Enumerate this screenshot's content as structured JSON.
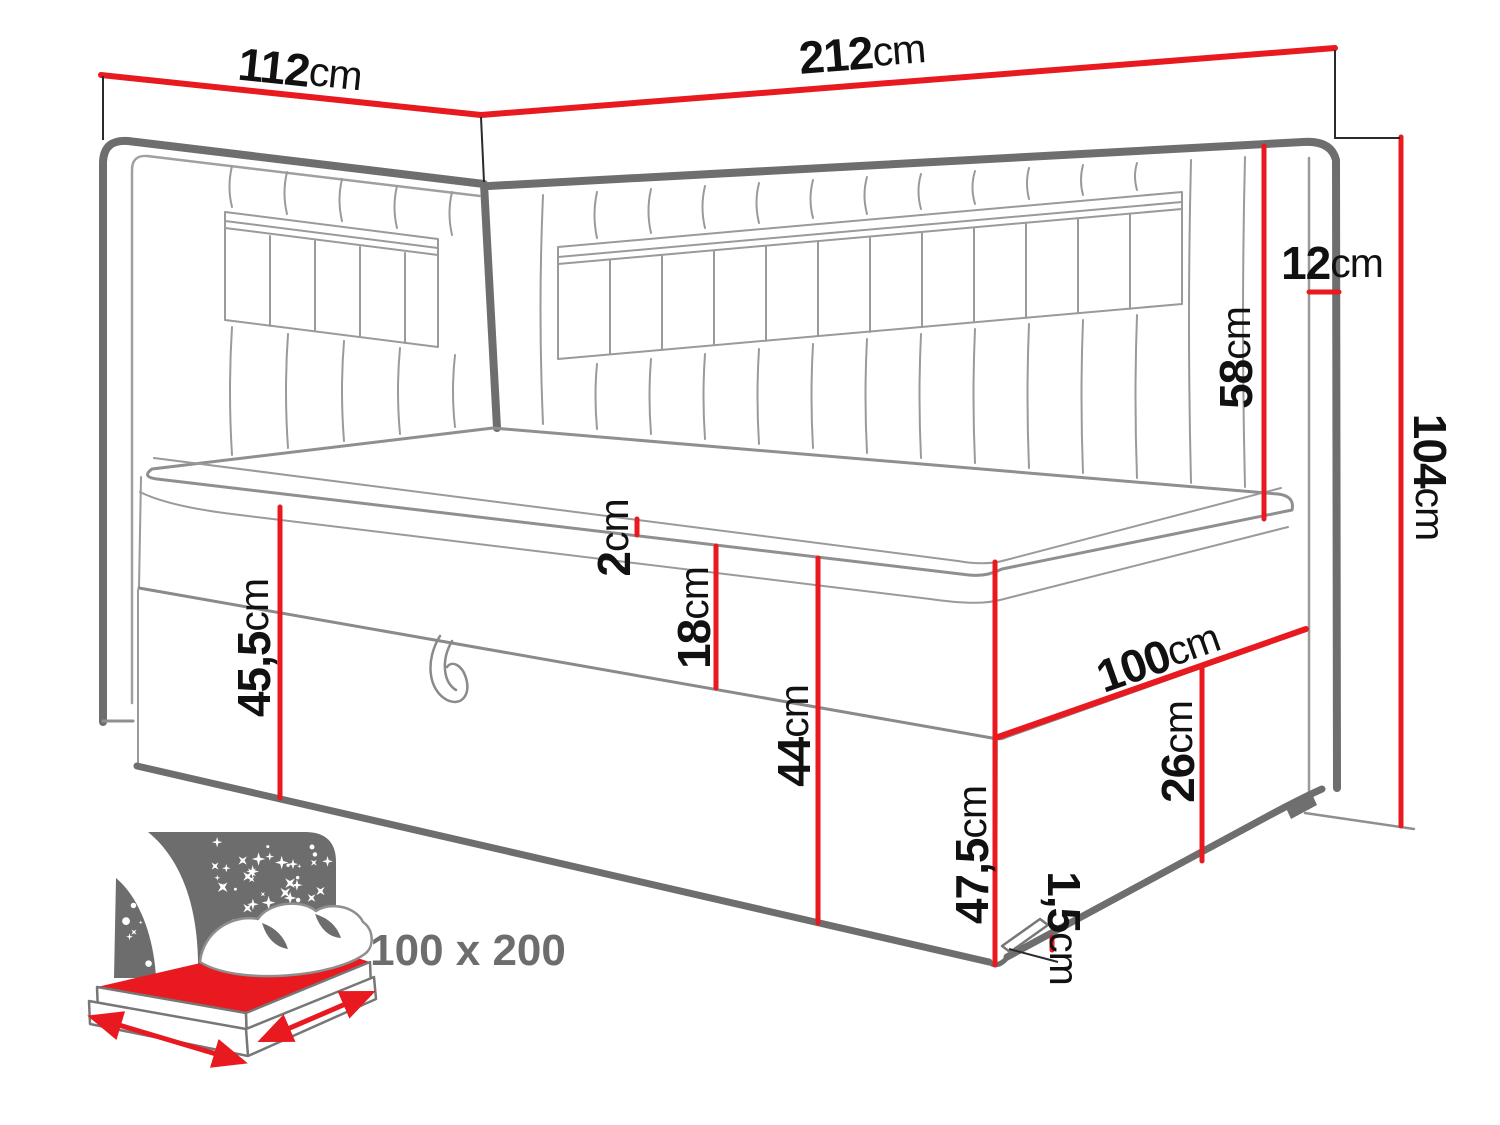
{
  "diagram": {
    "dims": {
      "left_width": {
        "value": "112",
        "unit": "cm"
      },
      "back_width": {
        "value": "212",
        "unit": "cm"
      },
      "headboard_thickness": {
        "value": "12",
        "unit": "cm"
      },
      "headboard_above_bed": {
        "value": "58",
        "unit": "cm"
      },
      "total_height": {
        "value": "104",
        "unit": "cm"
      },
      "topper_height": {
        "value": "2",
        "unit": "cm"
      },
      "mattress_height": {
        "value": "18",
        "unit": "cm"
      },
      "left_base_height": {
        "value": "45,5",
        "unit": "cm"
      },
      "front_panel_height": {
        "value": "44",
        "unit": "cm"
      },
      "front_corner_height": {
        "value": "47,5",
        "unit": "cm"
      },
      "bed_width": {
        "value": "100",
        "unit": "cm"
      },
      "side_panel_height": {
        "value": "26",
        "unit": "cm"
      },
      "leg_height": {
        "value": "1,5",
        "unit": "cm"
      }
    },
    "sleeping_area_label": "100 x 200",
    "colors": {
      "dimension_red": "#e8191f",
      "outline_gray": "#6e6e6e",
      "icon_gray": "#6d6d6d",
      "label_black": "#111111"
    }
  }
}
